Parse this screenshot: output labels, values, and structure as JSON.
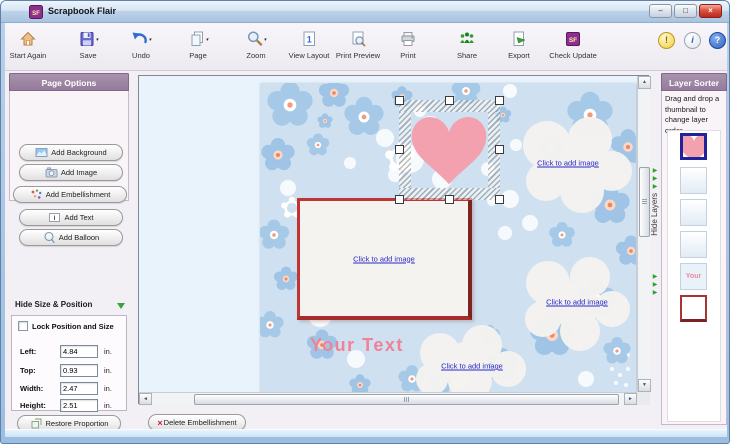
{
  "window": {
    "title": "Scrapbook Flair"
  },
  "icons": {
    "app_badge": "SF",
    "minimize": "–",
    "maximize": "□",
    "close": "×",
    "dropdown": "▾",
    "collapse_arrow": "▼",
    "scroll_up": "▲",
    "scroll_down": "▼",
    "scroll_left": "◄",
    "scroll_right": "►",
    "green_arrow": "▶",
    "tip": "!",
    "info": "i",
    "help": "?",
    "delete_x": "×",
    "layout_one": "1",
    "text_i": "I"
  },
  "toolbar": {
    "items": [
      {
        "label": "Start Again"
      },
      {
        "label": "Save"
      },
      {
        "label": "Undo"
      },
      {
        "label": "Page"
      },
      {
        "label": "Zoom"
      },
      {
        "label": "View Layout"
      },
      {
        "label": "Print Preview"
      },
      {
        "label": "Print"
      },
      {
        "label": "Share"
      },
      {
        "label": "Export"
      },
      {
        "label": "Check Update"
      }
    ]
  },
  "page_options": {
    "title": "Page Options",
    "buttons": [
      {
        "label": "Add Background"
      },
      {
        "label": "Add Image"
      },
      {
        "label": "Add Embellishment"
      },
      {
        "label": "Add Text"
      },
      {
        "label": "Add Balloon"
      }
    ]
  },
  "size_position": {
    "header": "Hide Size & Position",
    "lock_label": "Lock Position and Size",
    "rows": [
      {
        "label": "Left:",
        "value": "4.84",
        "unit": "in."
      },
      {
        "label": "Top:",
        "value": "0.93",
        "unit": "in."
      },
      {
        "label": "Width:",
        "value": "2.47",
        "unit": "in."
      },
      {
        "label": "Height:",
        "value": "2.51",
        "unit": "in."
      }
    ],
    "restore_label": "Restore Proportion"
  },
  "canvas": {
    "links": [
      {
        "label": "Click to add image"
      },
      {
        "label": "Click to add image"
      },
      {
        "label": "Click to add image"
      },
      {
        "label": "Click to add image"
      }
    ],
    "your_text": "Your Text"
  },
  "layer_sorter": {
    "title": "Layer Sorter",
    "instruction": "Drag and drop a thumbnail to change layer order.",
    "hide_layers_label": "Hide Layers",
    "your_thumb_label": "Your"
  },
  "bottom": {
    "delete_label": "Delete Embellishment"
  },
  "colors": {
    "header_purple": "#9c82a2",
    "heart_pink": "#f3a1af",
    "link_blue": "#2a2ac8",
    "your_text_pink": "#ef8298",
    "frame_red": "#c03434",
    "selected_thumb_border": "#22229b",
    "green_arrow": "#2da32d",
    "canvas_blue": "#cfe1f0"
  }
}
